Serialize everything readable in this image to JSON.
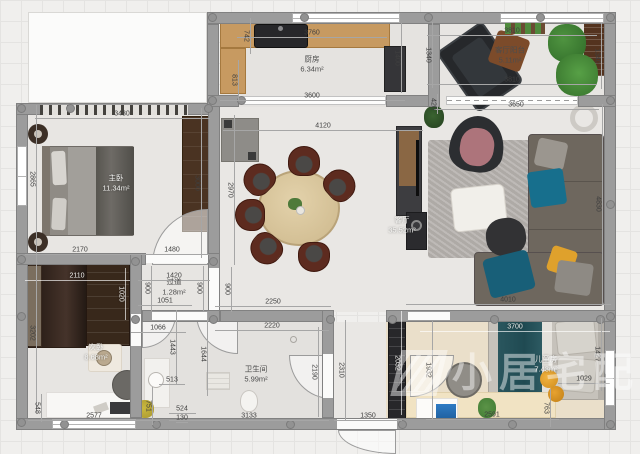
{
  "canvas": {
    "width": 640,
    "height": 454
  },
  "watermark": {
    "text": "小居宅配",
    "logo": "brand-mark"
  },
  "palette": {
    "wall": "#9c9c9c",
    "wood_counter": "#c79a61",
    "dark_wood": "#4a3322",
    "teal_cushion": "#176f8d",
    "yellow_cushion": "#dfa12c",
    "pink_chair": "#ad747b",
    "plant_green": "#3f7a33",
    "kids_floor": "#eadfca"
  },
  "rooms": [
    {
      "name": "厨房",
      "area": "6.34m²",
      "x": 312,
      "y": 64,
      "light": false
    },
    {
      "name": "客厅阳台",
      "area": "5.11m²",
      "x": 510,
      "y": 55,
      "light": false
    },
    {
      "name": "客厅",
      "area": "35.52m²",
      "x": 402,
      "y": 225,
      "light": true
    },
    {
      "name": "主卧",
      "area": "11.34m²",
      "x": 116,
      "y": 183,
      "light": true
    },
    {
      "name": "过道",
      "area": "1.28m²",
      "x": 174,
      "y": 287,
      "light": false
    },
    {
      "name": "次卧",
      "area": "8.68m²",
      "x": 96,
      "y": 352,
      "light": true
    },
    {
      "name": "卫生间",
      "area": "5.99m²",
      "x": 256,
      "y": 374,
      "light": false
    },
    {
      "name": "儿童房",
      "area": "7.43m²",
      "x": 546,
      "y": 364,
      "light": true
    }
  ],
  "dims": [
    {
      "t": "3760",
      "x": 312,
      "y": 33,
      "r": 0,
      "len": 150
    },
    {
      "t": "742",
      "x": 246,
      "y": 36,
      "r": 1,
      "len": 36
    },
    {
      "t": "813",
      "x": 234,
      "y": 80,
      "r": 1,
      "len": 40
    },
    {
      "t": "3600",
      "x": 312,
      "y": 96,
      "r": 0,
      "len": 185
    },
    {
      "t": "1400",
      "x": 397,
      "y": 58,
      "r": 1,
      "len": 70
    },
    {
      "t": "3810",
      "x": 512,
      "y": 31,
      "r": 0,
      "len": 170
    },
    {
      "t": "1340",
      "x": 428,
      "y": 55,
      "r": 1,
      "len": 66
    },
    {
      "t": "1340",
      "x": 597,
      "y": 56,
      "r": 1,
      "len": 66
    },
    {
      "t": "3810",
      "x": 512,
      "y": 80,
      "r": 0,
      "len": 170
    },
    {
      "t": "3650",
      "x": 516,
      "y": 105,
      "r": 0,
      "len": 165
    },
    {
      "t": "420",
      "x": 433,
      "y": 104,
      "r": 1,
      "len": 20
    },
    {
      "t": "3430",
      "x": 122,
      "y": 114,
      "r": 0,
      "len": 175
    },
    {
      "t": "4120",
      "x": 323,
      "y": 126,
      "r": 0,
      "len": 200
    },
    {
      "t": "2970",
      "x": 230,
      "y": 190,
      "r": 1,
      "len": 150
    },
    {
      "t": "3000",
      "x": 197,
      "y": 183,
      "r": 1,
      "len": 150
    },
    {
      "t": "2865",
      "x": 32,
      "y": 179,
      "r": 1,
      "len": 148
    },
    {
      "t": "4830",
      "x": 598,
      "y": 204,
      "r": 1,
      "len": 200
    },
    {
      "t": "2170",
      "x": 80,
      "y": 250,
      "r": 0,
      "len": 110
    },
    {
      "t": "1480",
      "x": 172,
      "y": 250,
      "r": 0,
      "len": 74
    },
    {
      "t": "2110",
      "x": 77,
      "y": 276,
      "r": 0,
      "len": 105,
      "light": true
    },
    {
      "t": "1020",
      "x": 121,
      "y": 294,
      "r": 1,
      "len": 52,
      "light": true
    },
    {
      "t": "3202",
      "x": 32,
      "y": 333,
      "r": 1,
      "len": 160
    },
    {
      "t": "1420",
      "x": 174,
      "y": 276,
      "r": 0,
      "len": 72
    },
    {
      "t": "1051",
      "x": 165,
      "y": 301,
      "r": 0,
      "len": 54
    },
    {
      "t": "900",
      "x": 147,
      "y": 288,
      "r": 1,
      "len": 45
    },
    {
      "t": "900",
      "x": 199,
      "y": 288,
      "r": 1,
      "len": 45
    },
    {
      "t": "900",
      "x": 227,
      "y": 289,
      "r": 1,
      "len": 45
    },
    {
      "t": "2250",
      "x": 273,
      "y": 302,
      "r": 0,
      "len": 116
    },
    {
      "t": "2220",
      "x": 272,
      "y": 326,
      "r": 0,
      "len": 114
    },
    {
      "t": "1066",
      "x": 158,
      "y": 328,
      "r": 0,
      "len": 55
    },
    {
      "t": "1443",
      "x": 172,
      "y": 347,
      "r": 1,
      "len": 74
    },
    {
      "t": "1644",
      "x": 203,
      "y": 354,
      "r": 1,
      "len": 84
    },
    {
      "t": "2190",
      "x": 314,
      "y": 372,
      "r": 1,
      "len": 90
    },
    {
      "t": "2310",
      "x": 341,
      "y": 370,
      "r": 1,
      "len": 100
    },
    {
      "t": "3133",
      "x": 249,
      "y": 416,
      "r": 0,
      "len": 160
    },
    {
      "t": "1350",
      "x": 368,
      "y": 416,
      "r": 0,
      "len": 68
    },
    {
      "t": "513",
      "x": 172,
      "y": 380,
      "r": 0,
      "len": 26
    },
    {
      "t": "524",
      "x": 182,
      "y": 409,
      "r": 0,
      "len": 27
    },
    {
      "t": "130",
      "x": 182,
      "y": 418,
      "r": 0,
      "len": 12
    },
    {
      "t": "2577",
      "x": 94,
      "y": 416,
      "r": 0,
      "len": 132
    },
    {
      "t": "548",
      "x": 37,
      "y": 408,
      "r": 1,
      "len": 28
    },
    {
      "t": "751",
      "x": 148,
      "y": 406,
      "r": 1,
      "len": 38
    },
    {
      "t": "4010",
      "x": 508,
      "y": 300,
      "r": 0,
      "len": 205
    },
    {
      "t": "3700",
      "x": 515,
      "y": 327,
      "r": 0,
      "len": 190,
      "light": true
    },
    {
      "t": "1427",
      "x": 597,
      "y": 354,
      "r": 1,
      "len": 73
    },
    {
      "t": "1029",
      "x": 584,
      "y": 379,
      "r": 0,
      "len": 52
    },
    {
      "t": "763",
      "x": 546,
      "y": 408,
      "r": 1,
      "len": 38
    },
    {
      "t": "2591",
      "x": 492,
      "y": 415,
      "r": 0,
      "len": 133
    },
    {
      "t": "2032",
      "x": 397,
      "y": 363,
      "r": 1,
      "len": 104,
      "light": true
    },
    {
      "t": "1932",
      "x": 428,
      "y": 370,
      "r": 1,
      "len": 98
    }
  ]
}
